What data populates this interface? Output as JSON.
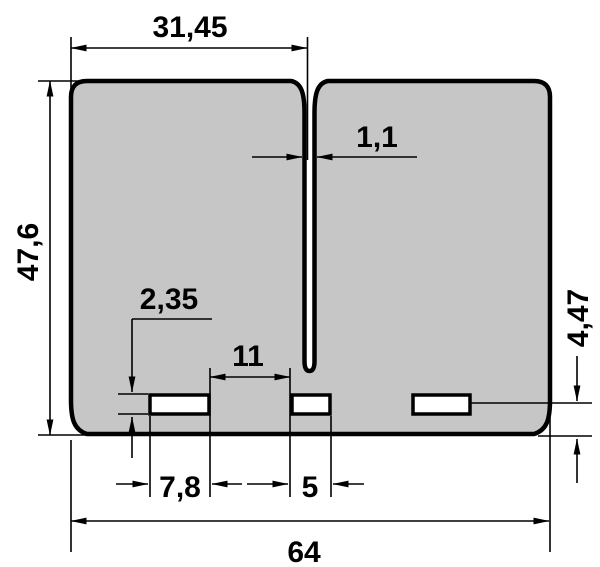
{
  "drawing": {
    "type": "technical-dimension-drawing",
    "colors": {
      "background": "#ffffff",
      "shape_fill": "#c6c6c6",
      "outline": "#000000"
    },
    "dimensions": {
      "top_slot_offset": "31,45",
      "center_slot_width": "1,1",
      "overall_height": "47,6",
      "port_height": "2,35",
      "port_gap": "11",
      "left_port_width": "7,8",
      "center_port_width": "5",
      "right_port_bottom_offset": "4,47",
      "overall_width": "64"
    }
  }
}
